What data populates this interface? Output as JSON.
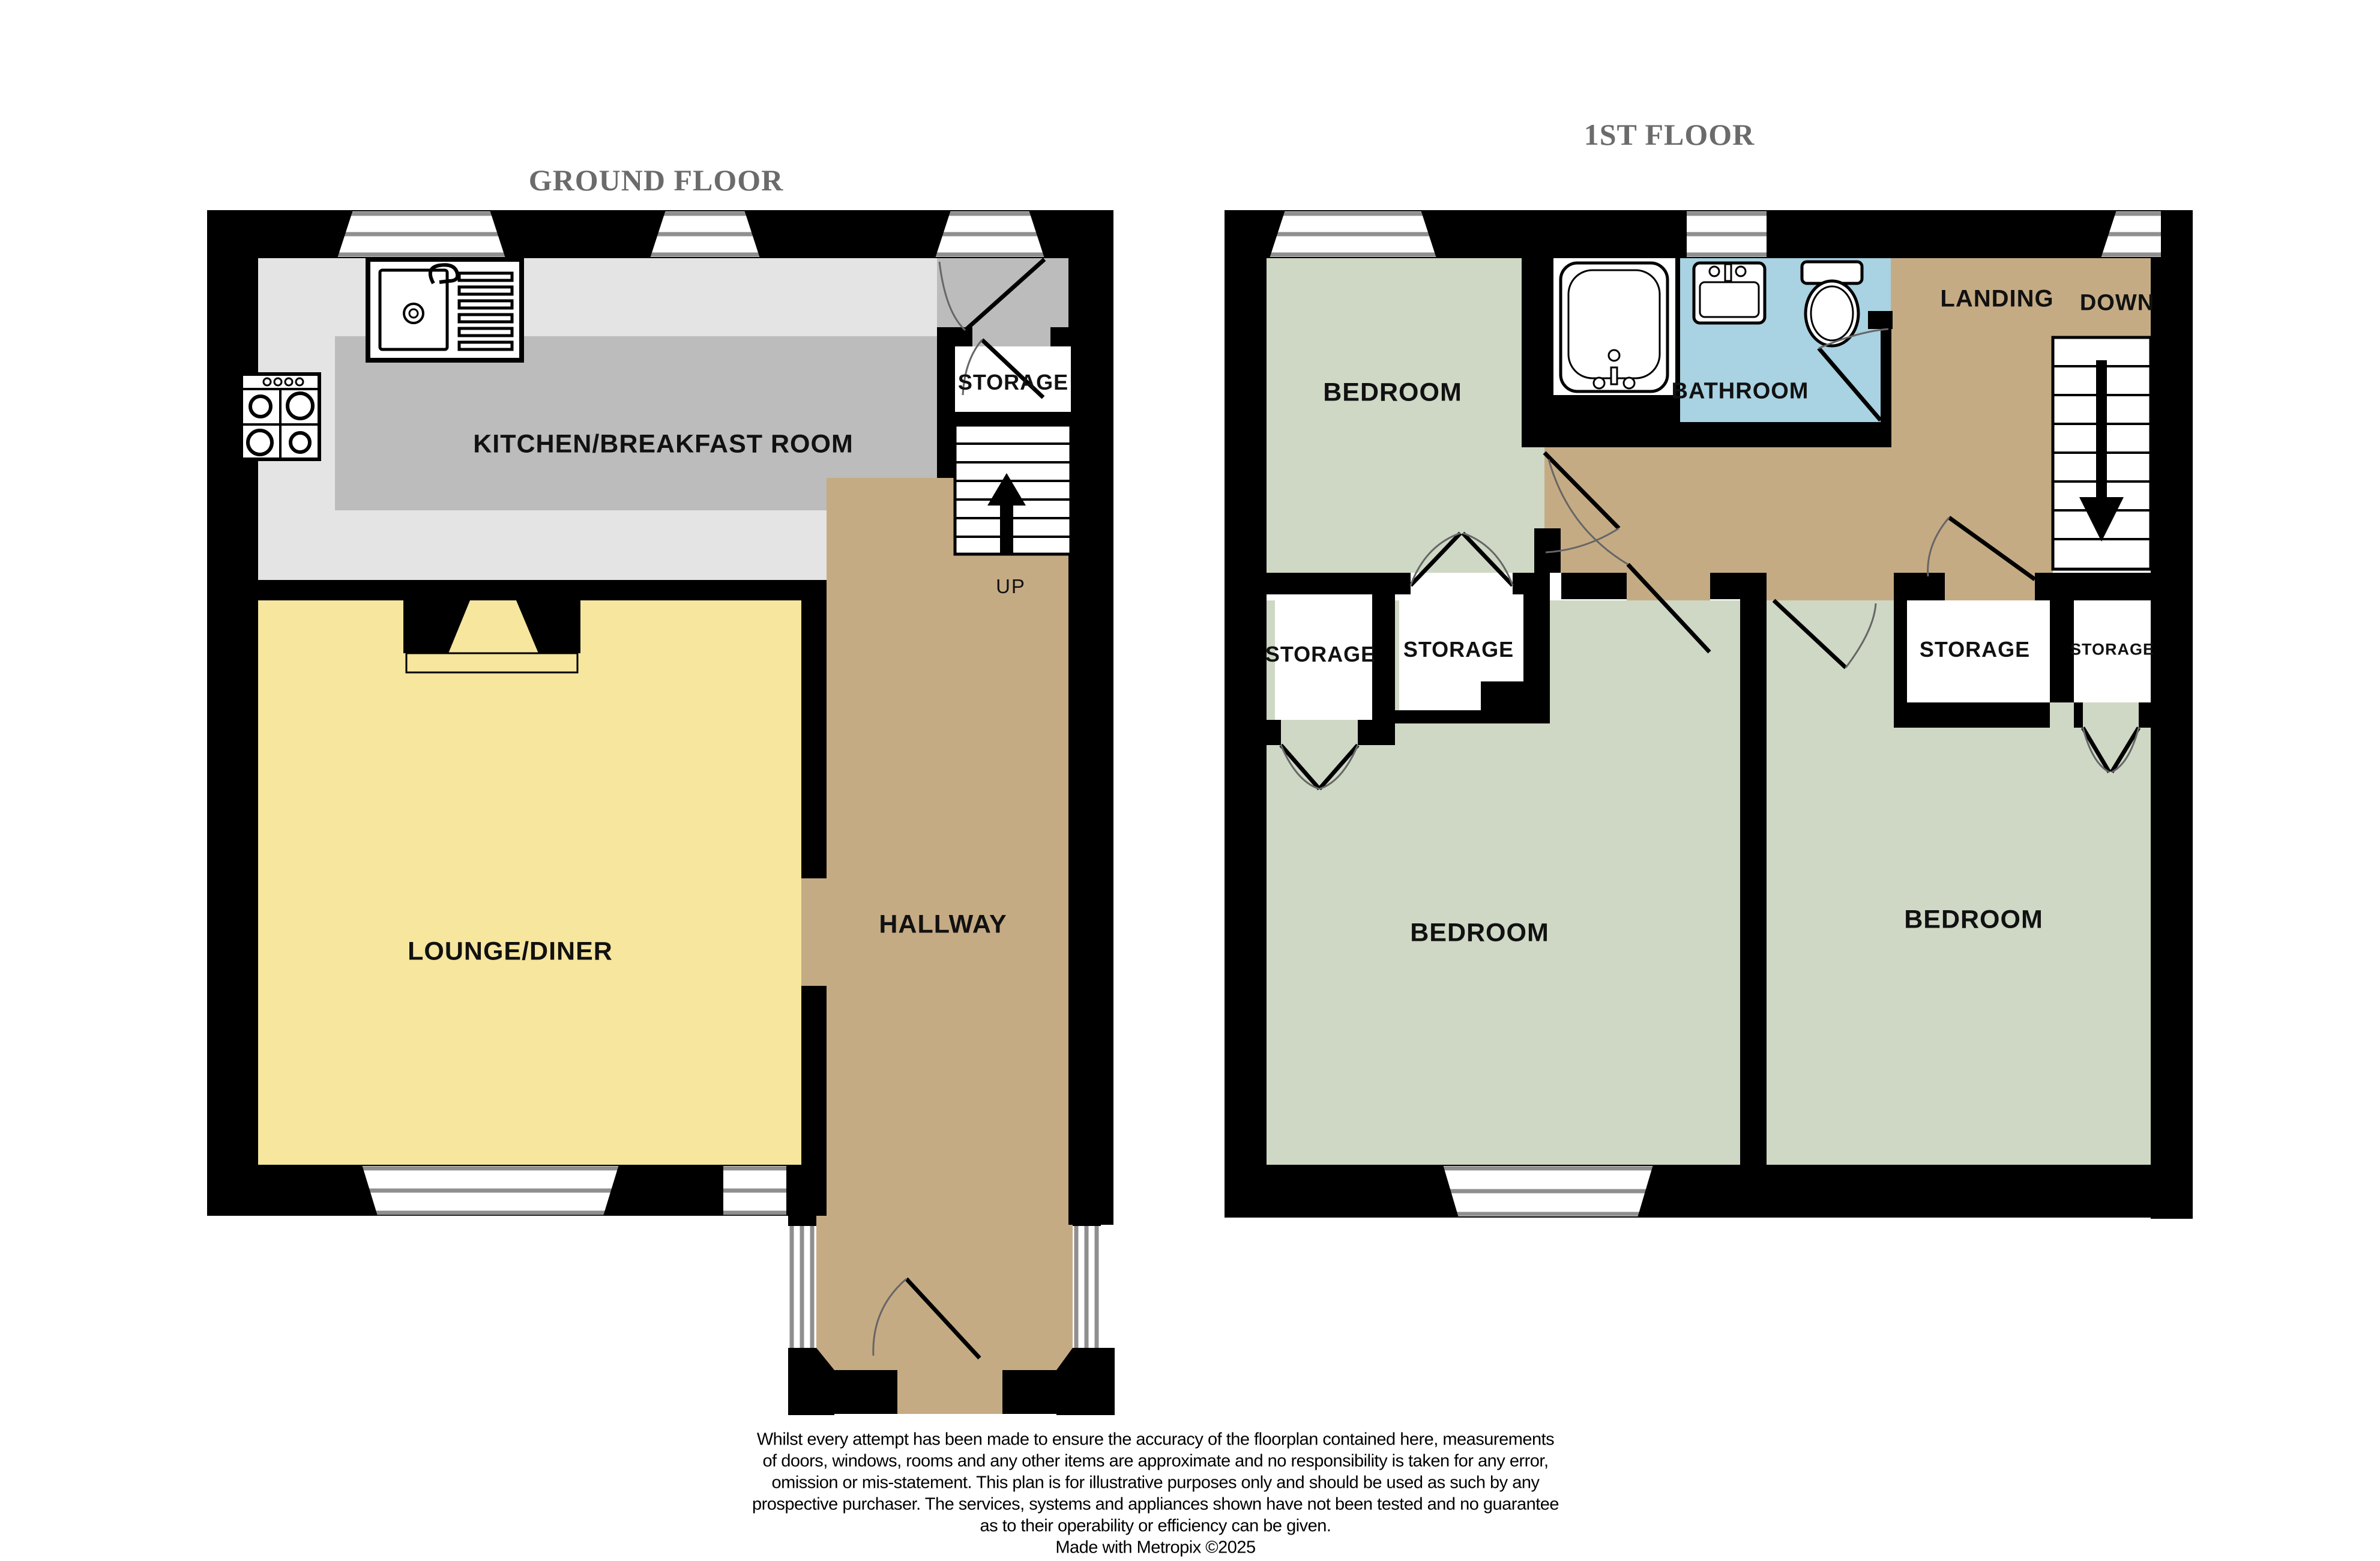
{
  "colors": {
    "wall": "#000000",
    "floor-light": "#e4e4e4",
    "floor-dark": "#bcbcbc",
    "floor-yellow": "#f6e69e",
    "floor-tan": "#c5ab84",
    "floor-green": "#ced8c5",
    "floor-blue": "#a9d2e2",
    "window-line": "#8f8f8f",
    "door-arc": "#666666",
    "title-text": "#6b6b6b",
    "label-text": "#111111"
  },
  "ground": {
    "title": "GROUND FLOOR",
    "rooms": {
      "kitchen": "KITCHEN/BREAKFAST ROOM",
      "storage": "STORAGE",
      "lounge": "LOUNGE/DINER",
      "hallway": "HALLWAY"
    },
    "stairs": {
      "up": "UP"
    }
  },
  "first": {
    "title": "1ST FLOOR",
    "rooms": {
      "bedroom_top": "BEDROOM",
      "bathroom": "BATHROOM",
      "landing": "LANDING",
      "storage_left_outer": "STORAGE",
      "storage_left_inner": "STORAGE",
      "storage_right_inner": "STORAGE",
      "storage_right_outer": "STORAGE",
      "bedroom_left": "BEDROOM",
      "bedroom_right": "BEDROOM"
    },
    "stairs": {
      "down": "DOWN"
    }
  },
  "footer": {
    "lines": [
      "Whilst every attempt has been made to ensure the accuracy of the floorplan contained here, measurements",
      "of doors, windows, rooms and any other items are approximate and no responsibility is taken for any error,",
      "omission or mis-statement. This plan is for illustrative purposes only and should be used as such by any",
      "prospective purchaser. The services, systems and appliances shown have not been tested and no guarantee",
      "as to their operability or efficiency can be given.",
      "Made with Metropix ©2025"
    ]
  }
}
